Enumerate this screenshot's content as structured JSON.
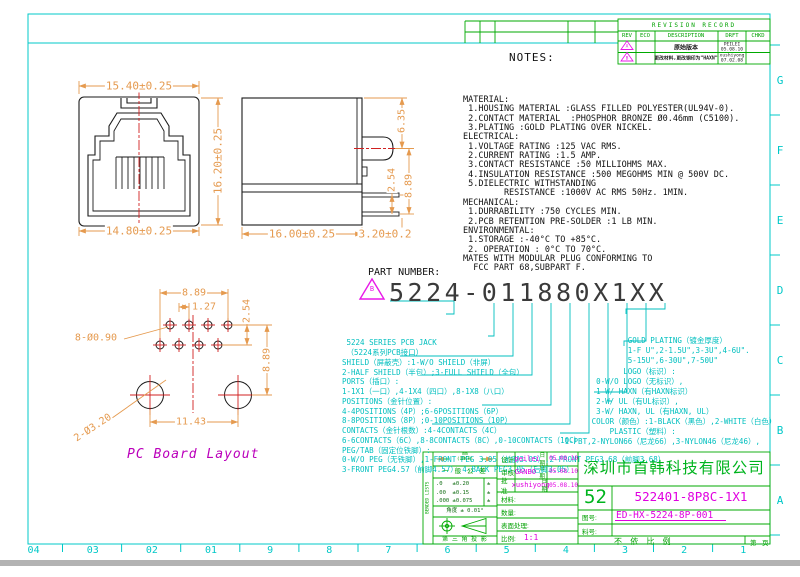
{
  "colors": {
    "frame_cyan": "#00C8C8",
    "callout_cyan": "#00BFBF",
    "table_green": "#00AA00",
    "magenta": "#E000E0",
    "dimension_orange": "#E59A4F",
    "centerline_red": "#D02020",
    "drawing_black": "#1A1A1A"
  },
  "frame": {
    "bottom_labels": [
      "04",
      "03",
      "02",
      "01",
      "9",
      "8",
      "7",
      "6",
      "5",
      "4",
      "3",
      "2",
      "1"
    ],
    "right_labels": [
      "G",
      "F",
      "E",
      "D",
      "C",
      "B",
      "A"
    ]
  },
  "revision_table": {
    "title": "REVISION RECORD",
    "headers": [
      "REV",
      "ECO",
      "DESCRIPTION",
      "DRFT",
      "CHKD"
    ],
    "rows": [
      {
        "rev": "A",
        "description": "原始版本",
        "drft": "PEILEI",
        "date": "05.08.10",
        "chkd": ""
      },
      {
        "rev": "B",
        "description": "更改材料,更改钢印为\"HAXN\"",
        "drft": "xushiyong",
        "date": "07.02.08",
        "chkd": ""
      }
    ]
  },
  "notes_title": "NOTES:",
  "notes_lines": [
    "MATERIAL:",
    " 1.HOUSING MATERIAL :GLASS FILLED POLYESTER(UL94V-0).",
    " 2.CONTACT MATERIAL  :PHOSPHOR BRONZE Ø0.46mm (C5100).",
    " 3.PLATING :GOLD PLATING OVER NICKEL.",
    "ELECTRICAL:",
    " 1.VOLTAGE RATING :125 VAC RMS.",
    " 2.CURRENT RATING :1.5 AMP.",
    " 3.CONTACT RESISTANCE :50 MILLIOHMS MAX.",
    " 4.INSULATION RESISTANCE :500 MEGOHMS MIN @ 500V DC.",
    " 5.DIELECTRIC WITHSTANDING",
    "        RESISTANCE :1000V AC RMS 50Hz. 1MIN.",
    "MECHANICAL:",
    " 1.DURRABILITY :750 CYCLES MIN.",
    " 2.PCB RETENTION PRE-SOLDER :1 LB MIN.",
    "ENVIRONMENTAL:",
    " 1.STORAGE :-40°C TO +85°C.",
    " 2. OPERATION : 0°C TO 70°C.",
    "MATES WITH MODULAR PLUG CONFORMING TO",
    "  FCC PART 68,SUBPART F."
  ],
  "part_number": {
    "label": "PART NUMBER:",
    "rev_mark": "B",
    "value": "5224-011880X1XX"
  },
  "callouts_left": [
    " 5224 SERIES PCB JACK",
    " （5224系列PCB接口）",
    "SHIELD（屏蔽壳）:1-W/O SHIELD（非屏）",
    "2-HALF SHIELD（半包）;3-FULL SHIELD（全包）",
    "PORTS（插口）:",
    "1-1X1（一口）,4-1X4（四口）,8-1X8（八口）",
    "POSITIONS（金针位置）:",
    "4-4POSITIONS（4P）;6-6POSITIONS（6P）",
    "8-8POSITIONS（8P）;0-10POSITIONS（10P）",
    "CONTACTS（金针根数）:4-4CONTACTS（4C）",
    "6-6CONTACTS（6C）,8-8CONTACTS（8C）,0-10CONTACTS（10C）",
    "PEG/TAB（固定位铁脚）:",
    "0-W/O PEG（无铁脚）,1-FRONT PEG 3.05（前脚3.05）,2-FRONT PEG3.68（前脚3.68）",
    "3-FRONT PEG4.57（前脚4.57）,4-BACK PEG3.05（后脚3.05）"
  ],
  "callouts_right": [
    "               GOLD PLATING（镀金厚度）",
    "               1-F U\",2-1.5U\",3-3U\",4-6U\".",
    "               5-15U\",6-30U\",7-50U\"",
    "              LOGO（标识）:",
    "        0-W/O LOGO（无标识）,",
    "        1-W/ HAXN（有HAXN标识）",
    "        2-W/ UL（有UL标识）,",
    "        3-W/ HAXN, UL（有HAXN, UL）",
    "       COLOR（颜色）:1-BLACK（黑色）,2-WHITE（白色）",
    "           PLASTIC（塑料）:",
    " 1-PBT,2-NYLON66（尼龙66）,3-NYLON46（尼龙46）,"
  ],
  "dims": {
    "front_width_top": "15.40±0.25",
    "front_height": "16.20±0.25",
    "front_width_bottom": "14.80±0.25",
    "side_h_top": "6.35",
    "side_pin_gap": "2.54",
    "side_h_total": "8.89",
    "side_depth": "16.00±0.25",
    "side_pin_len": "3.20±0.2",
    "pcb_row_span": "8.89",
    "pcb_offset": "1.27",
    "pcb_row_gap": "2.54",
    "pcb_small_holes": "8-Ø0.90",
    "pcb_height": "8.89",
    "pcb_big_holes": "2-Ø3.20",
    "pcb_hole_span": "11.43",
    "pcb_caption": "PC Board Layout"
  },
  "title_block": {
    "company": "深圳市首韩科技有限公司",
    "series_no": "52",
    "part_no": "522401-8P8C-1X1",
    "drawing_no_label": "图号:",
    "drawing_no": "ED-HX-5224-8P-001",
    "material_no_label": "料号:",
    "material_no": "",
    "scale_note": "不 依 比 例",
    "sheet_label": "第",
    "page_label": "页",
    "sign_rows": [
      {
        "label": "设计",
        "name": "peilei",
        "date_label": "日期",
        "date": "05.08.10"
      },
      {
        "label": "审核",
        "name": "GANBO",
        "date_label": "日期",
        "date": "05.08.10"
      },
      {
        "label": "批准",
        "name": "xushiyong",
        "date_label": "日期",
        "date": "05.08.10"
      }
    ],
    "info_rows": [
      {
        "label": "材料:",
        "value": ""
      },
      {
        "label": "数量:",
        "value": ""
      },
      {
        "label": "表面处理:",
        "value": ""
      },
      {
        "label": "比例:",
        "value": "1:1"
      }
    ],
    "tolerance": {
      "unit": "mm\n(INCH)",
      "general": "一 般 公 差",
      "values": ".0   ±0.20\n.00  ±0.15\n.000 ±0.075",
      "inch_col": "±\n±\n±",
      "angle": "角度 ± 0.01°",
      "projection": "第 三 角 投 影",
      "side_text": "BENDED LISTS"
    }
  }
}
